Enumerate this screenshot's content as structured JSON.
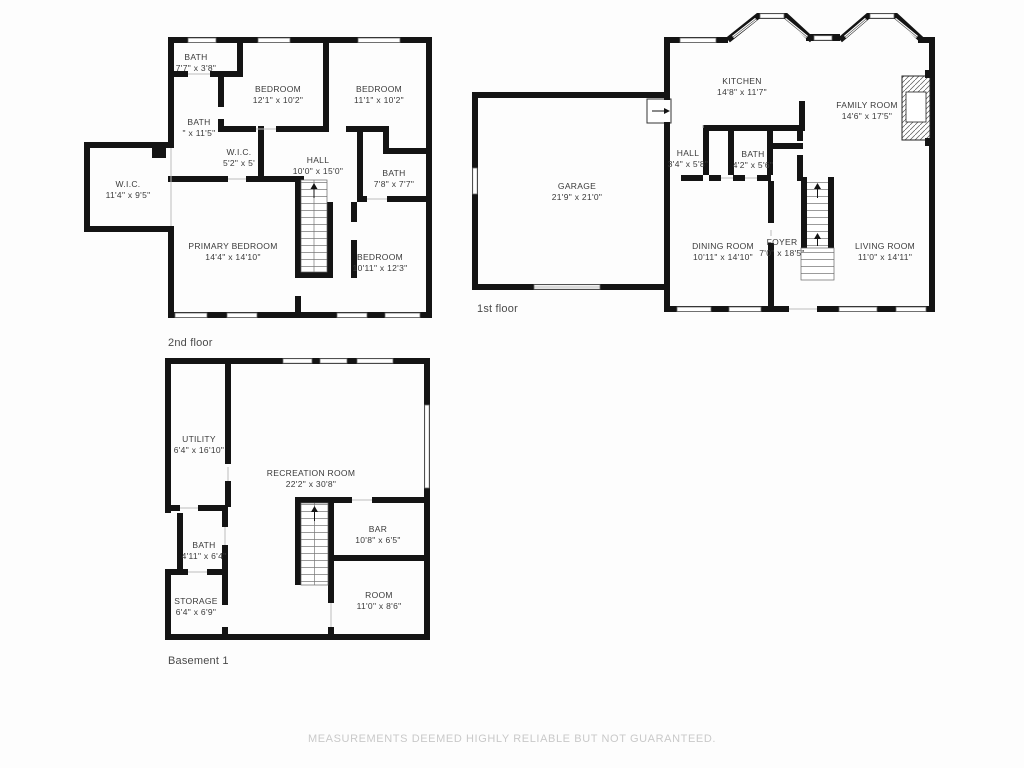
{
  "colors": {
    "wall": "#141414",
    "background": "#fdfdfd",
    "label_text": "#3a3a3a",
    "disclaimer_text": "#c9c9c9"
  },
  "footer": {
    "disclaimer": "MEASUREMENTS DEEMED HIGHLY RELIABLE BUT NOT GUARANTEED."
  },
  "floors": {
    "second": {
      "caption": "2nd floor",
      "rooms": {
        "bath_top": {
          "name": "BATH",
          "dims": "7'7\" x 3'8\""
        },
        "bedroom_left": {
          "name": "BEDROOM",
          "dims": "12'1\" x 10'2\""
        },
        "bedroom_right": {
          "name": "BEDROOM",
          "dims": "11'1\" x 10'2\""
        },
        "bath_mid": {
          "name": "BATH",
          "dims": "\" x 11'5\""
        },
        "wic_small": {
          "name": "W.I.C.",
          "dims": "5'2\" x 5'"
        },
        "wic_large": {
          "name": "W.I.C.",
          "dims": "11'4\" x 9'5\""
        },
        "hall": {
          "name": "HALL",
          "dims": "10'0\" x 15'0\""
        },
        "bath_right": {
          "name": "BATH",
          "dims": "7'8\" x 7'7\""
        },
        "primary": {
          "name": "PRIMARY BEDROOM",
          "dims": "14'4\" x 14'10\""
        },
        "bedroom_bottom": {
          "name": "BEDROOM",
          "dims": "10'11\" x 12'3\""
        }
      }
    },
    "first": {
      "caption": "1st floor",
      "rooms": {
        "garage": {
          "name": "GARAGE",
          "dims": "21'9\" x 21'0\""
        },
        "kitchen": {
          "name": "KITCHEN",
          "dims": "14'8\" x 11'7\""
        },
        "family": {
          "name": "FAMILY ROOM",
          "dims": "14'6\" x 17'5\""
        },
        "hall": {
          "name": "HALL",
          "dims": "3'4\" x 5'8\""
        },
        "bath": {
          "name": "BATH",
          "dims": "4'2\" x 5'6\""
        },
        "dining": {
          "name": "DINING ROOM",
          "dims": "10'11\" x 14'10\""
        },
        "foyer": {
          "name": "FOYER",
          "dims": "7'0\" x 18'5\""
        },
        "living": {
          "name": "LIVING ROOM",
          "dims": "11'0\" x 14'11\""
        }
      }
    },
    "basement": {
      "caption": "Basement 1",
      "rooms": {
        "utility": {
          "name": "UTILITY",
          "dims": "6'4\" x 16'10\""
        },
        "recreation": {
          "name": "RECREATION ROOM",
          "dims": "22'2\" x 30'8\""
        },
        "bath": {
          "name": "BATH",
          "dims": "4'11\" x 6'4\""
        },
        "storage": {
          "name": "STORAGE",
          "dims": "6'4\" x 6'9\""
        },
        "bar": {
          "name": "BAR",
          "dims": "10'8\" x 6'5\""
        },
        "room": {
          "name": "ROOM",
          "dims": "11'0\" x 8'6\""
        }
      }
    }
  }
}
